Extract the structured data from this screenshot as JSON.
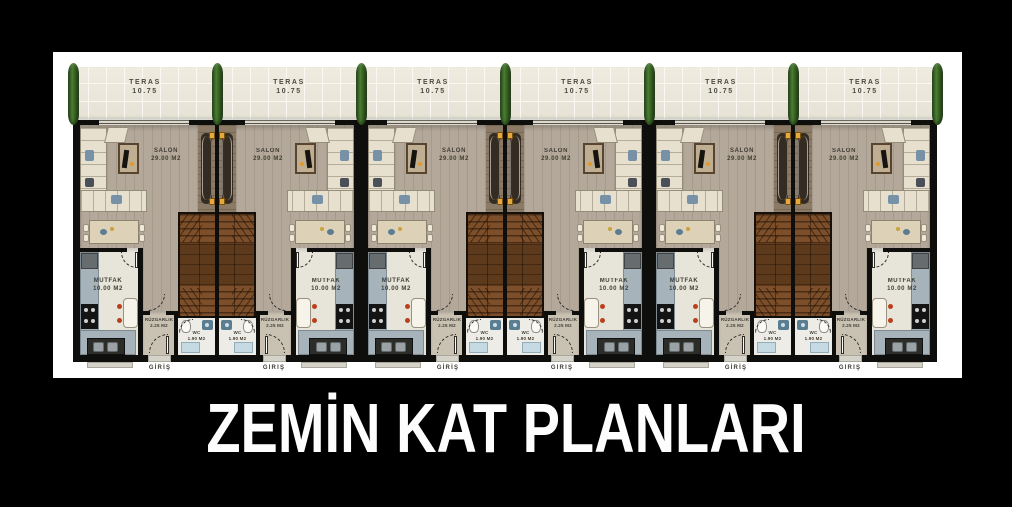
{
  "title": "ZEMİN KAT PLANLARI",
  "plan": {
    "unit_count": 6,
    "rooms": {
      "teras": {
        "name": "TERAS",
        "area": "10.75"
      },
      "salon": {
        "name": "SALON",
        "area": "29.00 M2"
      },
      "mutfak": {
        "name": "MUTFAK",
        "area": "10.00 M2"
      },
      "ruzgarlik": {
        "name": "RÜZGARLIK",
        "area": "2.25 M2"
      },
      "wc": {
        "name": "WC",
        "area": "1.90 M2"
      },
      "giris": {
        "name": "GİRİŞ"
      }
    },
    "colors": {
      "background": "#000000",
      "paper": "#ffffff",
      "terrace_tile": "#eae7db",
      "salon_floor": "#b3a899",
      "kitchen_floor": "#e7e4da",
      "corridor_wood": "#8b7b66",
      "stair_wood": "#7c4e29",
      "counter": "#a7b3ba",
      "sofa": "#e7e0ce",
      "tree": "#3e6b2c",
      "newel": "#e7a83e",
      "wall": "#0e0e0c"
    }
  }
}
